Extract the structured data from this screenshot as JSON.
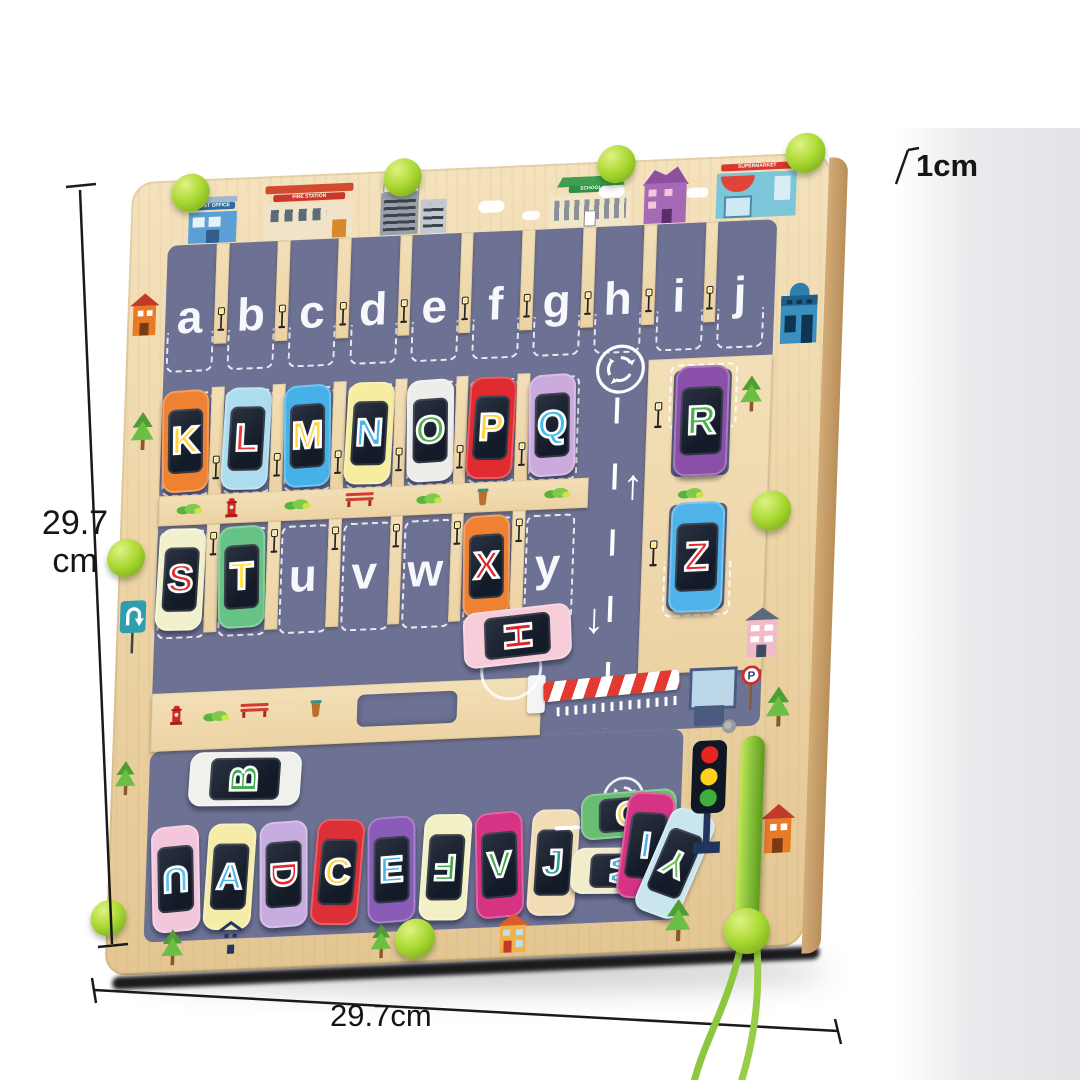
{
  "annotations": {
    "side": "29.7",
    "side_unit": "cm",
    "bottom": "29.7cm",
    "thickness": "1cm"
  },
  "board": {
    "top_parking_letters": [
      "a",
      "b",
      "c",
      "d",
      "e",
      "f",
      "g",
      "h",
      "i",
      "j"
    ],
    "empty_slot_letters": [
      "u",
      "v",
      "w",
      "y"
    ],
    "buildings": [
      {
        "name": "post-office",
        "sign": "POST OFFICE",
        "sign_color": "#2f6ba0",
        "body_color": "#5aa0d6"
      },
      {
        "name": "fire-station",
        "sign": "FIRE STATION",
        "sign_color": "#c9382c",
        "body_color": "#f0e3c8"
      },
      {
        "name": "hospital",
        "sign": "HOSPITAL",
        "sign_color": "#ffffff",
        "body_color": "#b8bcc4"
      },
      {
        "name": "school",
        "sign": "SCHOOL",
        "sign_color": "#2f8f42",
        "body_color": "#f2e6c8"
      },
      {
        "name": "purple-house",
        "sign": "",
        "sign_color": "",
        "body_color": "#a569b5"
      },
      {
        "name": "supermarket",
        "sign": "SUPERMARKET",
        "sign_color": "#d8372e",
        "body_color": "#7cc6da"
      }
    ],
    "row2_cars": [
      {
        "letter": "K",
        "body": "#ee8132",
        "letter_color": "#ffd23e"
      },
      {
        "letter": "L",
        "body": "#aedcef",
        "letter_color": "#e8393d"
      },
      {
        "letter": "M",
        "body": "#45b1e8",
        "letter_color": "#ffd23e"
      },
      {
        "letter": "N",
        "body": "#f7eda0",
        "letter_color": "#46b4ea"
      },
      {
        "letter": "O",
        "body": "#ededea",
        "letter_color": "#52b04a"
      },
      {
        "letter": "P",
        "body": "#e02b31",
        "letter_color": "#ffd23e"
      },
      {
        "letter": "Q",
        "body": "#cdaade",
        "letter_color": "#3cc0ea"
      }
    ],
    "row3_slots": [
      {
        "letter": "S",
        "body": "#f1f2cd",
        "letter_color": "#e02b31",
        "empty": false
      },
      {
        "letter": "T",
        "body": "#66c285",
        "letter_color": "#ffe14d",
        "empty": false
      },
      {
        "letter": "u",
        "empty": true
      },
      {
        "letter": "v",
        "empty": true
      },
      {
        "letter": "w",
        "empty": true
      },
      {
        "letter": "X",
        "body": "#ee8132",
        "letter_color": "#d8262c",
        "empty": false
      },
      {
        "letter": "y",
        "empty": true
      }
    ],
    "right_cars": [
      {
        "letter": "R",
        "body": "#8a4fa8",
        "letter_color": "#4caf50"
      },
      {
        "letter": "Z",
        "body": "#4fb2e8",
        "letter_color": "#e02b31"
      }
    ],
    "free_cars": [
      {
        "letter": "H",
        "body": "#f6cdd9",
        "letter_color": "#e01f26"
      },
      {
        "letter": "B",
        "body": "#f0f0ec",
        "letter_color": "#3fae4d"
      }
    ],
    "bottom_cars": [
      {
        "letter": "U",
        "body": "#f3c6dc",
        "letter_color": "#55c4f0",
        "letter_rot": 180,
        "tilt": -3
      },
      {
        "letter": "A",
        "body": "#f5ecaa",
        "letter_color": "#4ab3ec",
        "letter_rot": 0,
        "tilt": 2
      },
      {
        "letter": "D",
        "body": "#c7addf",
        "letter_color": "#e02b31",
        "letter_rot": 90,
        "tilt": -2
      },
      {
        "letter": "C",
        "body": "#dd2f36",
        "letter_color": "#ffd23e",
        "letter_rot": 0,
        "tilt": 3
      },
      {
        "letter": "E",
        "body": "#8a5cb8",
        "letter_color": "#4ab3ec",
        "letter_rot": 0,
        "tilt": -2
      },
      {
        "letter": "F",
        "body": "#f2f0c4",
        "letter_color": "#45a949",
        "letter_rot": 180,
        "tilt": 2
      },
      {
        "letter": "V",
        "body": "#d63384",
        "letter_color": "#45a949",
        "letter_rot": 0,
        "tilt": -3
      },
      {
        "letter": "J",
        "body": "#f0ddb6",
        "letter_color": "#2aa198",
        "letter_rot": 0,
        "tilt": 2
      }
    ],
    "bottom_free_cars": [
      {
        "letter": "G",
        "body": "#68bd72",
        "letter_color": "#ffd23e",
        "orientation": "h",
        "letter_rot": 0
      },
      {
        "letter": "W",
        "body": "#f1ecca",
        "letter_color": "#4ab3ec",
        "orientation": "h",
        "letter_rot": 90
      },
      {
        "letter": "I",
        "body": "#d63384",
        "letter_color": "#4ab3ec",
        "orientation": "v",
        "letter_rot": 0
      },
      {
        "letter": "Y",
        "body": "#c9e6ee",
        "letter_color": "#69bf4e",
        "orientation": "v",
        "letter_rot": 185
      }
    ],
    "colors": {
      "road": "#6d7294",
      "wood": "#ecd3a4",
      "ball_green": "#a9d832",
      "pen_green": "#8dc63f"
    }
  }
}
